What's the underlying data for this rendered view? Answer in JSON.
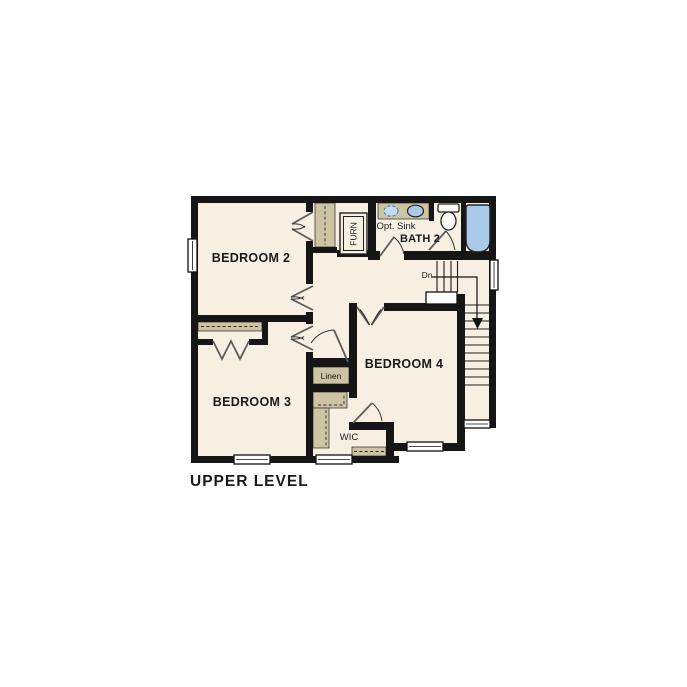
{
  "plan_title": "UPPER LEVEL",
  "labels": {
    "bedroom2": "BEDROOM 2",
    "bedroom3": "BEDROOM 3",
    "bedroom4": "BEDROOM 4",
    "bath2": "BATH 2",
    "optional_sink": "Opt. Sink",
    "furnace": "FURN",
    "linen": "Linen",
    "wic": "WIC",
    "stairs_down": "Dn"
  },
  "colors": {
    "wall": "#161616",
    "floor": "#f7f0e2",
    "casework": "#cec4a4",
    "fixture": "#a9cbe9",
    "fixture-opt": "#c6daee",
    "bg": "#ffffff",
    "ink": "#1a1a1a"
  }
}
